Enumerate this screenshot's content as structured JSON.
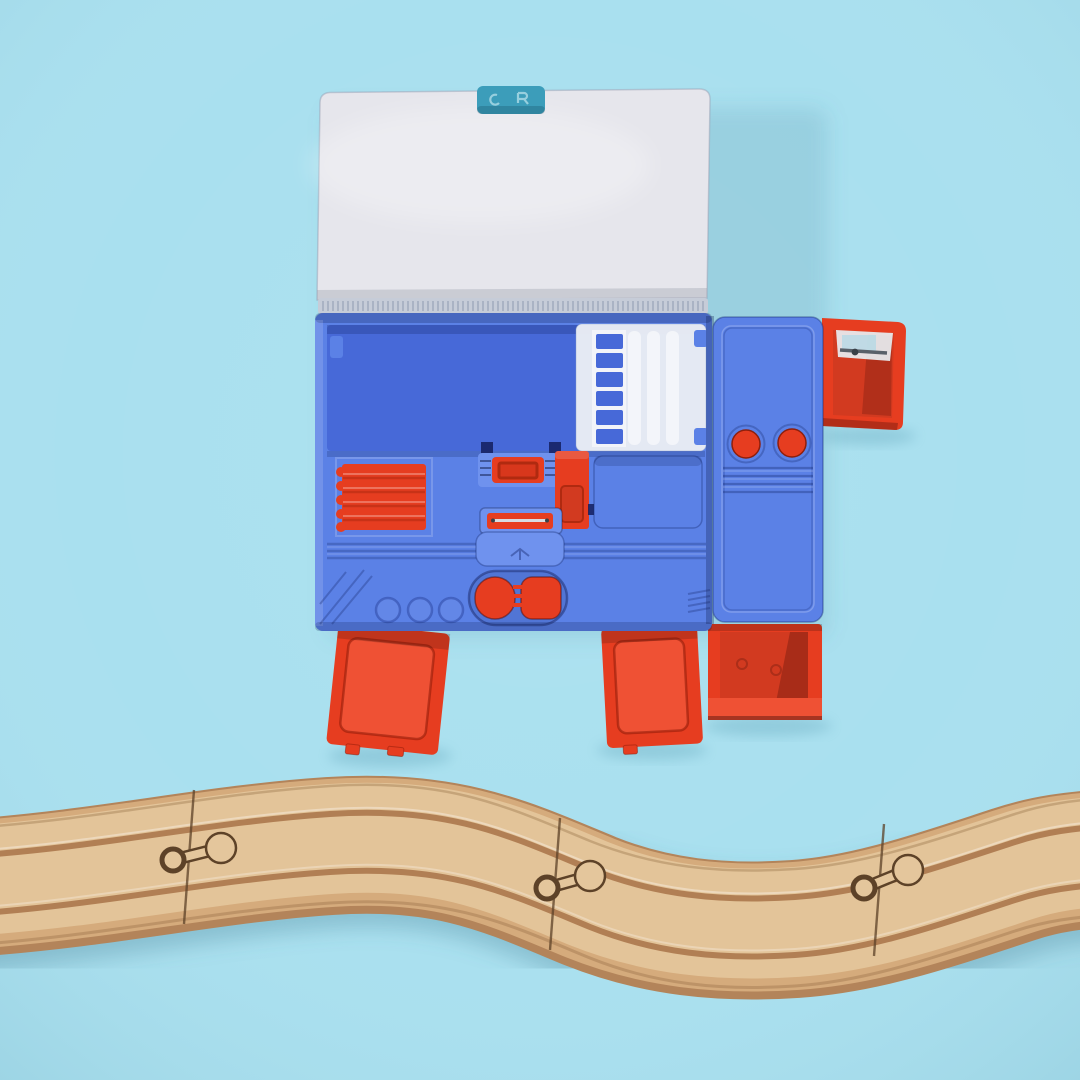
{
  "scene": {
    "type": "photograph",
    "subject": "Opened blue multi-compartment pencil box toy with red pop-out drawers, above a curved wooden toy train track on a plain light blue background",
    "background": "plain light blue surface",
    "foreground": "S-curved wooden train track crossing the full width near the bottom"
  },
  "colors": {
    "bg": "#a9e0ef",
    "bgDeep": "#9bd8ea",
    "shadow": "#4f94ab",
    "lid": "#e6e6ec",
    "lidEdge": "#c2c6d0",
    "latch": "#3c9dba",
    "hinge": "#c6ccd8",
    "hingeTick": "#94a0b4",
    "bodyBlue": "#5b81e6",
    "bodyBlueLight": "#6f92ee",
    "trayBlue": "#4769d8",
    "blueDark": "#33509e",
    "blueLine": "#4a6bd0",
    "navySlot": "#141f5e",
    "insertWhite": "#edf0f4",
    "red": "#e63d20",
    "redBright": "#ef5134",
    "redMid": "#d23a20",
    "redDark": "#b02a10",
    "redDeep": "#8e1f0c",
    "silver": "#d7dbe1",
    "sharpenerBody": "#e9f2f6",
    "blade": "#596069",
    "woodLight": "#e4c69c",
    "woodMid": "#d5ab7c",
    "woodDark": "#b3845a",
    "woodGroove": "#a87348",
    "woodSeam": "#5d4228"
  },
  "objects": [
    {
      "name": "pencil-case-lid",
      "description": "white lid flipped open upward",
      "color_ref": "lid"
    },
    {
      "name": "lid-latch",
      "description": "teal latch tab at top center of lid",
      "color_ref": "latch"
    },
    {
      "name": "case-body",
      "description": "blue pencil box body with inner compartments",
      "color_ref": "bodyBlue"
    },
    {
      "name": "pen-holder-insert",
      "description": "translucent white pen holder tray with 6 slots",
      "color_ref": "insertWhite",
      "slots": 6
    },
    {
      "name": "eraser-block",
      "description": "red ribbed eraser block in lower-left compartment",
      "color_ref": "red"
    },
    {
      "name": "push-button",
      "description": "red rectangular push button on center bracket",
      "color_ref": "red"
    },
    {
      "name": "slide-switch",
      "description": "red vertical slide switch mechanism",
      "color_ref": "red"
    },
    {
      "name": "blade-slot",
      "description": "red bar holding a thin metal blade",
      "color_ref": "red"
    },
    {
      "name": "twin-buttons",
      "description": "pair of red pill-shaped release buttons at bottom center",
      "color_ref": "red",
      "count": 2
    },
    {
      "name": "round-buttons",
      "description": "two round red buttons on right side panel",
      "color_ref": "red",
      "count": 2
    },
    {
      "name": "sharpener-drawer",
      "description": "red pop-out drawer at top right holding a clear pencil sharpener",
      "color_ref": "red"
    },
    {
      "name": "drawer-left",
      "description": "red pop-out tray tilted outward at bottom left",
      "color_ref": "red"
    },
    {
      "name": "drawer-middle",
      "description": "red pop-out tray at bottom middle",
      "color_ref": "red"
    },
    {
      "name": "drawer-right",
      "description": "red open storage box at bottom right",
      "color_ref": "red"
    },
    {
      "name": "train-track",
      "description": "wooden toy train track, S-curve, three pieces joined by peg-and-keyhole connectors",
      "color_ref": "woodMid",
      "pieces": 3,
      "joints": 3
    }
  ]
}
